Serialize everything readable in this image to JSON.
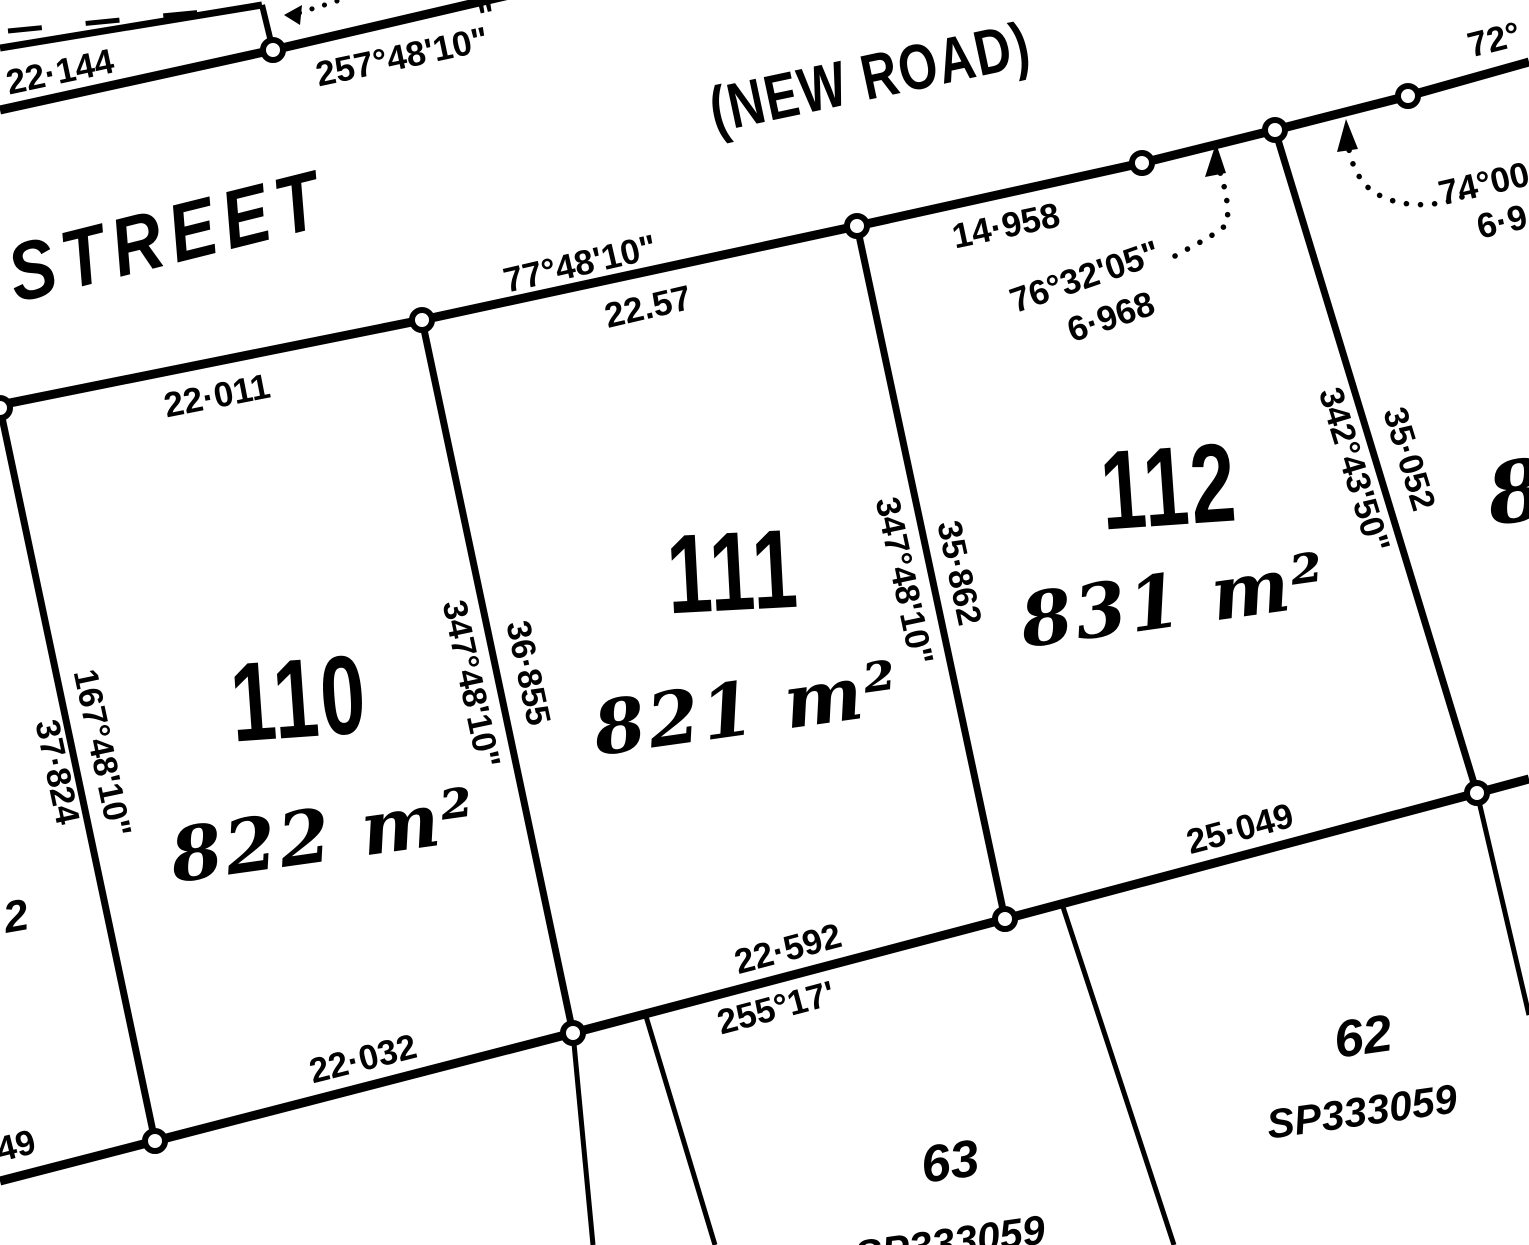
{
  "plan": {
    "type": "cadastral survey plan",
    "ink_color": "#000000",
    "paper_color": "#ffffff"
  },
  "roads": {
    "street_name": "STREET",
    "new_road": "(NEW ROAD)"
  },
  "lots": [
    {
      "number": "110",
      "area": "822 m²"
    },
    {
      "number": "111",
      "area": "821 m²"
    },
    {
      "number": "112",
      "area": "831 m²"
    },
    {
      "number": "63",
      "plan": "SP333059"
    },
    {
      "number": "62",
      "plan": "SP333059"
    },
    {
      "number_partial": "8"
    }
  ],
  "labels": {
    "d_22_144": "22·144",
    "b_257_48_10": "257°48'10\"",
    "partial_seconds": "\"",
    "d_22_011": "22·011",
    "b_77_48_10": "77°48'10\"",
    "d_22_57": "22.57",
    "d_14_958": "14·958",
    "b_76_32_05": "76°32'05\"",
    "d_6_968": "6·968",
    "b_74_00": "74°00",
    "d_6_9": "6·9",
    "b_72": "72°",
    "b_167_48_10": "167°48'10\"",
    "d_37_824": "37·824",
    "b_347_48_10_a": "347°48'10\"",
    "d_36_855": "36·855",
    "b_347_48_10_b": "347°48'10\"",
    "d_35_862": "35·862",
    "b_342_43_50": "342°43'50\"",
    "d_35_052": "35·052",
    "d_25_049": "25·049",
    "d_22_592": "22·592",
    "b_255_17": "255°17'",
    "d_22_032": "22·032",
    "partial_49": "49",
    "partial_2": "2"
  }
}
